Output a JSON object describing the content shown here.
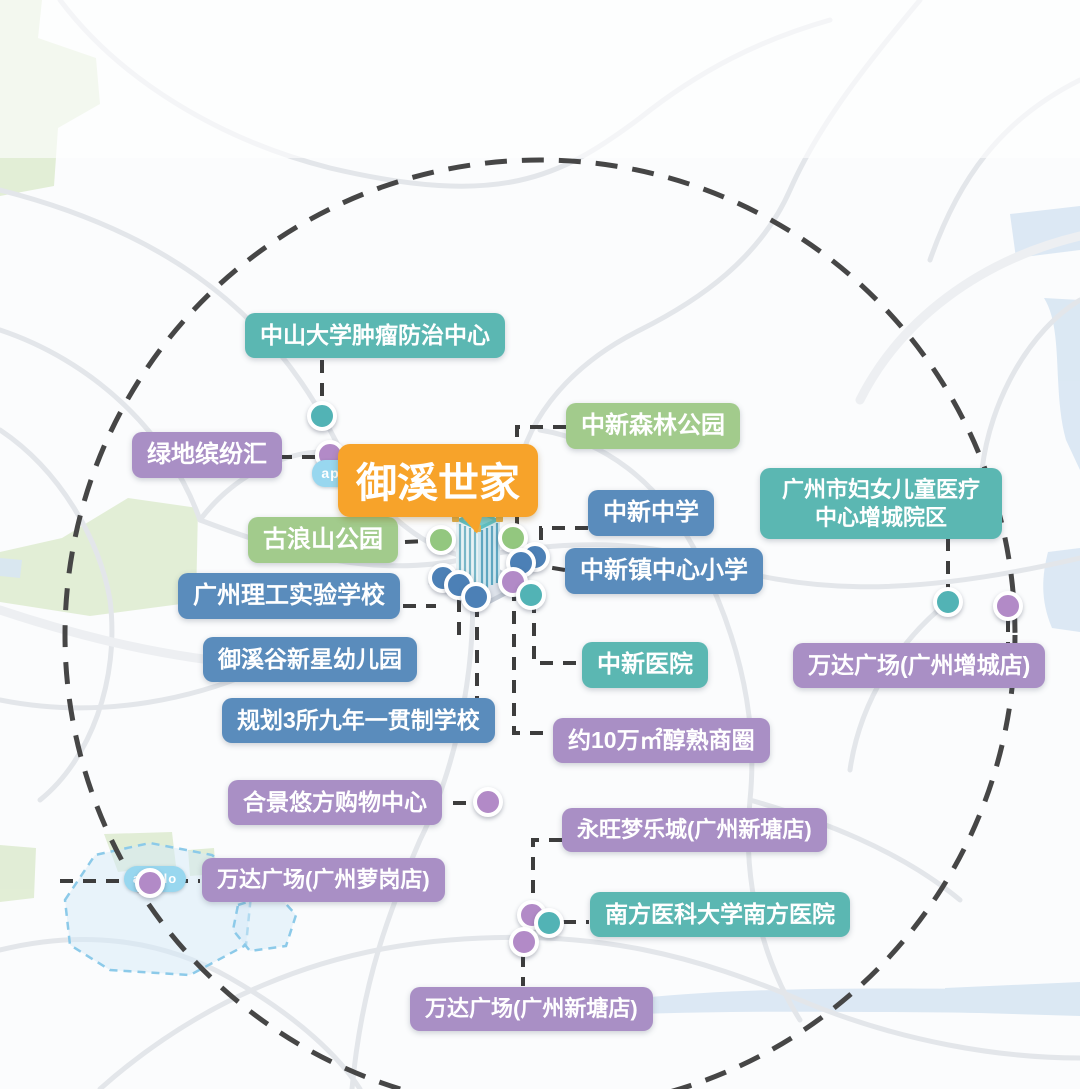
{
  "header": {
    "title": "御溪世家生活配套圈示意图",
    "subtitle": "数据来源：综合整理 仅供参考,具体以官方公布为准"
  },
  "center": {
    "label": "御溪世家"
  },
  "life_circle_label": "生活圈",
  "apollo": {
    "logo_text": "apollo",
    "zone1_line1": "广州市黄埔自动驾驶",
    "zone1_line2": "公交示范区(知识城)",
    "zone2_line1": "黄埔智能网联",
    "zone2_line2": "汽车应用示范区"
  },
  "colors": {
    "teal": "#5bb7b2",
    "blue": "#5a8cbc",
    "green": "#a2cb8c",
    "purple": "#a98fc5",
    "orange": "#f7a32a",
    "dot_teal": "#52b3b5",
    "dot_purple": "#b28ac7",
    "dot_green": "#93c77f",
    "dot_blue": "#4c80b6"
  },
  "pois": [
    {
      "id": "zhongda-cancer-center",
      "label": "中山大学肿瘤防治中心",
      "color": "teal",
      "x": 245,
      "y": 313,
      "fs": 23
    },
    {
      "id": "greenland-mall",
      "label": "绿地缤纷汇",
      "color": "purple",
      "x": 132,
      "y": 432
    },
    {
      "id": "zhongxin-forest-park",
      "label": "中新森林公园",
      "color": "green",
      "x": 566,
      "y": 403
    },
    {
      "id": "women-children-hospital",
      "label": "广州市妇女儿童医疗中心增城院区",
      "color": "teal",
      "x": 760,
      "y": 468,
      "w": 212,
      "fs": 22,
      "wrap": true
    },
    {
      "id": "zhongxin-middle-school",
      "label": "中新中学",
      "color": "blue",
      "x": 588,
      "y": 490
    },
    {
      "id": "zhongxin-central-primary",
      "label": "中新镇中心小学",
      "color": "blue",
      "x": 565,
      "y": 548
    },
    {
      "id": "gulangshan-park",
      "label": "古浪山公园",
      "color": "green",
      "x": 248,
      "y": 517
    },
    {
      "id": "ligong-experimental-school",
      "label": "广州理工实验学校",
      "color": "blue",
      "x": 178,
      "y": 573
    },
    {
      "id": "yuxigu-kindergarten",
      "label": "御溪谷新星幼儿园",
      "color": "blue",
      "x": 203,
      "y": 637,
      "fs": 23
    },
    {
      "id": "zhongxin-hospital",
      "label": "中新医院",
      "color": "teal",
      "x": 582,
      "y": 642
    },
    {
      "id": "wanda-zengcheng",
      "label": "万达广场(广州增城店)",
      "color": "purple",
      "x": 793,
      "y": 643,
      "fs": 23
    },
    {
      "id": "planned-schools",
      "label": "规划3所九年一贯制学校",
      "color": "blue",
      "x": 222,
      "y": 698,
      "fs": 23
    },
    {
      "id": "mature-business-circle",
      "label": "约10万㎡醇熟商圈",
      "color": "purple",
      "x": 553,
      "y": 718,
      "fs": 23
    },
    {
      "id": "hejing-youfang-mall",
      "label": "合景悠方购物中心",
      "color": "purple",
      "x": 228,
      "y": 780,
      "fs": 23
    },
    {
      "id": "aeon-dream-mall",
      "label": "永旺梦乐城(广州新塘店)",
      "color": "purple",
      "x": 562,
      "y": 808,
      "fs": 22
    },
    {
      "id": "wanda-luogang",
      "label": "万达广场(广州萝岗店)",
      "color": "purple",
      "x": 202,
      "y": 858,
      "fs": 22
    },
    {
      "id": "southern-medical-hospital",
      "label": "南方医科大学南方医院",
      "color": "teal",
      "x": 590,
      "y": 892,
      "fs": 23
    },
    {
      "id": "wanda-xintang",
      "label": "万达广场(广州新塘店)",
      "color": "purple",
      "x": 410,
      "y": 987,
      "fs": 22
    }
  ],
  "dots": [
    {
      "id": "dot-cancer-center",
      "x": 322,
      "y": 416,
      "color": "dot_teal"
    },
    {
      "id": "dot-greenland",
      "x": 330,
      "y": 455,
      "color": "dot_purple"
    },
    {
      "id": "dot-park-west",
      "x": 441,
      "y": 540,
      "color": "dot_green"
    },
    {
      "id": "dot-park-east",
      "x": 513,
      "y": 538,
      "color": "dot_green"
    },
    {
      "id": "dot-school-ne1",
      "x": 535,
      "y": 557,
      "color": "dot_blue"
    },
    {
      "id": "dot-school-ne2",
      "x": 521,
      "y": 563,
      "color": "dot_blue"
    },
    {
      "id": "dot-school-sw1",
      "x": 443,
      "y": 578,
      "color": "dot_blue"
    },
    {
      "id": "dot-school-sw2",
      "x": 459,
      "y": 585,
      "color": "dot_blue"
    },
    {
      "id": "dot-school-sw3",
      "x": 476,
      "y": 597,
      "color": "dot_blue"
    },
    {
      "id": "dot-biz-circle",
      "x": 513,
      "y": 582,
      "color": "dot_purple"
    },
    {
      "id": "dot-zhongxin-hospital",
      "x": 531,
      "y": 595,
      "color": "dot_teal"
    },
    {
      "id": "dot-women-children",
      "x": 948,
      "y": 602,
      "color": "dot_teal"
    },
    {
      "id": "dot-wanda-zengcheng",
      "x": 1008,
      "y": 606,
      "color": "dot_purple"
    },
    {
      "id": "dot-hejing",
      "x": 488,
      "y": 802,
      "color": "dot_purple"
    },
    {
      "id": "dot-wanda-luogang",
      "x": 150,
      "y": 883,
      "color": "dot_purple"
    },
    {
      "id": "dot-aeon",
      "x": 532,
      "y": 915,
      "color": "dot_purple"
    },
    {
      "id": "dot-southern-hospital",
      "x": 549,
      "y": 923,
      "color": "dot_teal"
    },
    {
      "id": "dot-wanda-xintang",
      "x": 524,
      "y": 942,
      "color": "dot_purple"
    }
  ],
  "connectors": [
    {
      "to": "zhongda-cancer-center",
      "points": [
        [
          322,
          360
        ],
        [
          322,
          402
        ]
      ]
    },
    {
      "to": "greenland-mall",
      "points": [
        [
          279,
          457
        ],
        [
          317,
          457
        ]
      ]
    },
    {
      "to": "gulangshan-park",
      "points": [
        [
          405,
          542
        ],
        [
          428,
          541
        ]
      ]
    },
    {
      "to": "zhongxin-forest-park",
      "points": [
        [
          566,
          427
        ],
        [
          517,
          427
        ],
        [
          517,
          528
        ]
      ]
    },
    {
      "to": "zhongxin-middle-school",
      "points": [
        [
          588,
          528
        ],
        [
          541,
          528
        ],
        [
          541,
          550
        ]
      ]
    },
    {
      "to": "zhongxin-central-primary",
      "points": [
        [
          565,
          570
        ],
        [
          547,
          567
        ]
      ]
    },
    {
      "to": "zhongxin-hospital",
      "points": [
        [
          534,
          600
        ],
        [
          534,
          663
        ],
        [
          582,
          663
        ]
      ]
    },
    {
      "to": "women-children-hospital",
      "points": [
        [
          948,
          538
        ],
        [
          948,
          590
        ]
      ]
    },
    {
      "to": "wanda-zengcheng",
      "points": [
        [
          1008,
          619
        ],
        [
          1008,
          643
        ]
      ]
    },
    {
      "to": "yuxigu-kindergarten",
      "points": [
        [
          459,
          599
        ],
        [
          459,
          637
        ]
      ]
    },
    {
      "to": "ligong-experimental-school",
      "points": [
        [
          403,
          606
        ],
        [
          436,
          606
        ]
      ]
    },
    {
      "to": "planned-schools",
      "points": [
        [
          477,
          604
        ],
        [
          477,
          698
        ]
      ]
    },
    {
      "to": "mature-business-circle",
      "points": [
        [
          514,
          588
        ],
        [
          514,
          733
        ],
        [
          552,
          733
        ]
      ]
    },
    {
      "to": "hejing-youfang-mall",
      "points": [
        [
          453,
          803
        ],
        [
          477,
          803
        ]
      ]
    },
    {
      "to": "wanda-luogang",
      "points": [
        [
          60,
          881
        ],
        [
          200,
          881
        ]
      ]
    },
    {
      "to": "aeon-dream-mall",
      "points": [
        [
          562,
          840
        ],
        [
          533,
          840
        ],
        [
          533,
          903
        ]
      ]
    },
    {
      "to": "southern-medical-hospital",
      "points": [
        [
          563,
          922
        ],
        [
          589,
          922
        ]
      ]
    },
    {
      "to": "wanda-xintang",
      "points": [
        [
          523,
          954
        ],
        [
          523,
          986
        ]
      ]
    }
  ],
  "road_labels": [
    {
      "text": "广汕一路",
      "x": 292,
      "y": 224,
      "rot": 20
    },
    {
      "text": "汕湛高速",
      "x": 144,
      "y": 356,
      "rot": 0,
      "vertical": true
    },
    {
      "text": "广河高速",
      "x": 128,
      "y": 638,
      "rot": -23
    },
    {
      "text": "广河高速",
      "x": 1014,
      "y": 224,
      "rot": 10
    },
    {
      "text": "广汕公路",
      "x": 838,
      "y": 596,
      "rot": 47
    },
    {
      "text": "广园快速路",
      "x": 570,
      "y": 946,
      "rot": 4
    },
    {
      "text": "北三路",
      "x": 668,
      "y": 1030,
      "rot": -18
    },
    {
      "text": "永宁北路",
      "x": 772,
      "y": 1038,
      "rot": 12
    }
  ]
}
